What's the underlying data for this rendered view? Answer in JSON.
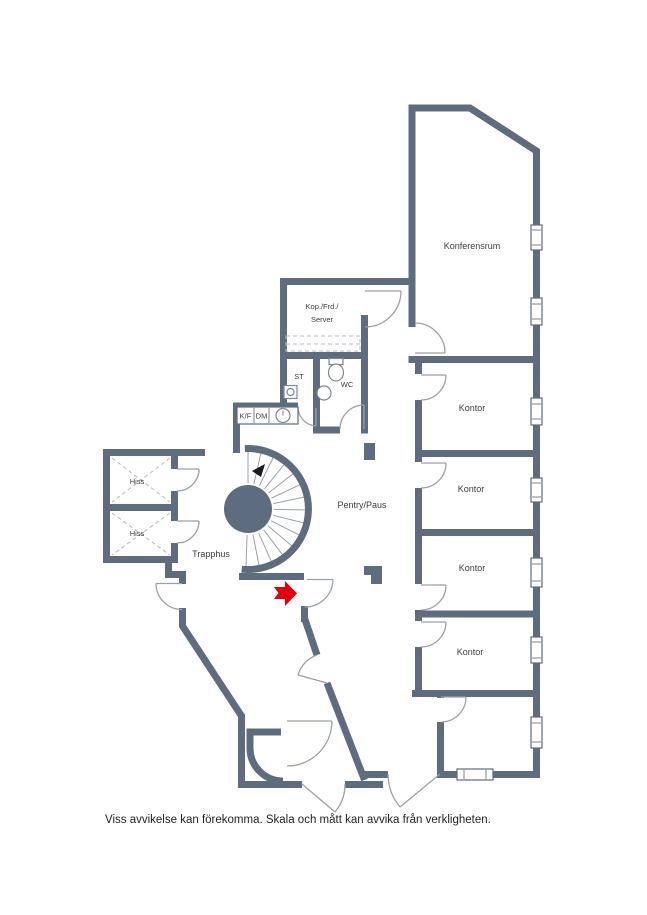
{
  "floorplan": {
    "rooms": {
      "konferensrum": "Konferensrum",
      "kontor": "Kontor",
      "pentry_paus": "Pentry/Paus",
      "trapphus": "Trapphus",
      "hiss": "Hiss",
      "kop_frd_server_line1": "Kop./Frd./",
      "kop_frd_server_line2": "Server",
      "st": "ST",
      "wc": "WC",
      "kf": "K/F",
      "dm": "DM"
    },
    "footer": "Viss avvikelse kan förekomma. Skala och mått kan avvika från verkligheten.",
    "colors": {
      "wall": "#5d6c7e",
      "window_fill": "#ffffff",
      "door_arc": "#9aa1a9",
      "entrance_arrow": "#e2000f",
      "stair_direction_arrow": "#1a1a1a",
      "text": "#3c3c3c",
      "footer_text": "#1f1f1f",
      "dashed_detail": "#b4bcc4"
    }
  }
}
